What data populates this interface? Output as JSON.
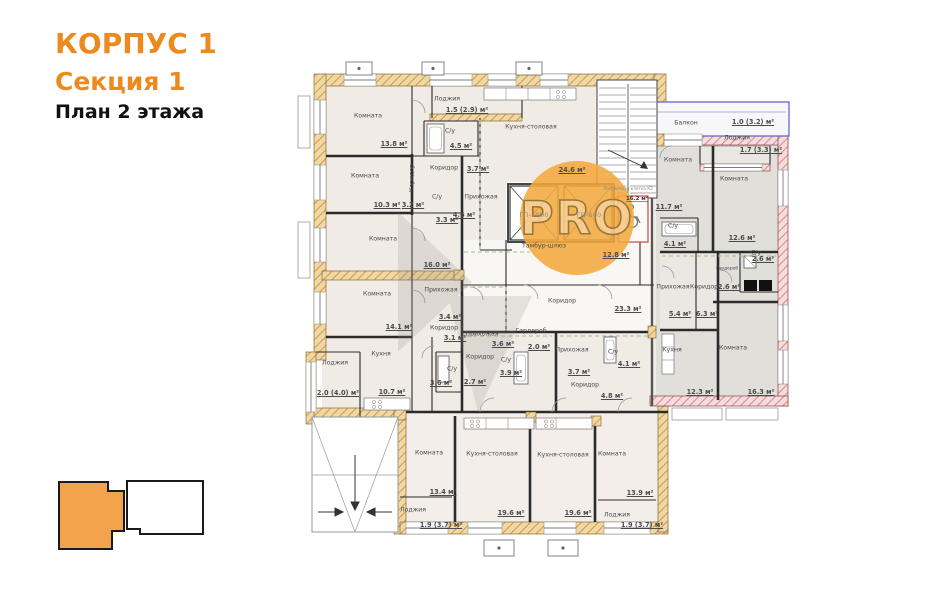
{
  "header": {
    "building": "КОРПУС 1",
    "section": "Секция 1",
    "floor": "План 2 этажа"
  },
  "watermark": {
    "text": "PRO"
  },
  "colors": {
    "accent": "#ec8a1d",
    "exterior_wall_hatch": "#cf9a44",
    "right_section_hatch": "#d08c8c",
    "balcony_outline": "#6868c6",
    "key_section_fill": "#f3a34c",
    "watermark_circle": "#f3a83c"
  },
  "elevators": [
    {
      "label": "ГП-1000"
    },
    {
      "label": "ГП-600"
    }
  ],
  "stairwell": {
    "label": "Лестничная клетка К2",
    "area": "16.2 м²"
  },
  "rooms": [
    {
      "name": "Комната",
      "area": "13.8 м²"
    },
    {
      "name": "Лоджия",
      "area": "1.5 (2.9) м²"
    },
    {
      "name": "С/у",
      "area": "4.5 м²"
    },
    {
      "name": "Кухня-столовая",
      "area": "24.6 м²"
    },
    {
      "name": "Комната",
      "area": "10.3 м²"
    },
    {
      "name": "Коридор",
      "area": "3.2 м²"
    },
    {
      "name": "Коридор",
      "area": "3.7 м²"
    },
    {
      "name": "С/у",
      "area": "3.3 м²"
    },
    {
      "name": "Прихожая",
      "area": "4.6 м²"
    },
    {
      "name": "Комната",
      "area": "16.0 м²"
    },
    {
      "name": "Комната",
      "area": "14.1 м²"
    },
    {
      "name": "Прихожая",
      "area": "3.4 м²"
    },
    {
      "name": "Коридор",
      "area": "3.1 м²"
    },
    {
      "name": "С/у",
      "area": "3.6 м²"
    },
    {
      "name": "",
      "area": "2.7 м²"
    },
    {
      "name": "Кухня",
      "area": "10.7 м²"
    },
    {
      "name": "Лоджия",
      "area": "2.0 (4.0) м²"
    },
    {
      "name": "Тамбур-шлюз",
      "area": "12.8 м²"
    },
    {
      "name": "Коридор",
      "area": "23.3 м²"
    },
    {
      "name": "Прихожая",
      "area": "3.6 м²"
    },
    {
      "name": "Гардероб",
      "area": "2.0 м²"
    },
    {
      "name": "Коридор",
      "area": ""
    },
    {
      "name": "С/у",
      "area": "3.9 м²"
    },
    {
      "name": "Прихожая",
      "area": "3.7 м²"
    },
    {
      "name": "С/у",
      "area": "4.1 м²"
    },
    {
      "name": "Коридор",
      "area": "4.8 м²"
    },
    {
      "name": "Комната",
      "area": "13.4 м²"
    },
    {
      "name": "Лоджия",
      "area": "1.9 (3.7) м²"
    },
    {
      "name": "Кухня-столовая",
      "area": "19.6 м²"
    },
    {
      "name": "Кухня-столовая",
      "area": "19.6 м²"
    },
    {
      "name": "Комната",
      "area": "13.9 м²"
    },
    {
      "name": "Лоджия",
      "area": "1.9 (3.7) м²"
    },
    {
      "name": "Балкон",
      "area": "1.0 (3.2) м²"
    },
    {
      "name": "Лоджия",
      "area": "1.7 (3.3) м²"
    },
    {
      "name": "Комната",
      "area": "11.7 м²"
    },
    {
      "name": "Комната",
      "area": "12.6 м²"
    },
    {
      "name": "С/у",
      "area": "4.1 м²"
    },
    {
      "name": "С/у",
      "area": "2.6 м²"
    },
    {
      "name": "Гардероб",
      "area": "2.6 м²"
    },
    {
      "name": "Прихожая",
      "area": "5.4 м²"
    },
    {
      "name": "Коридор",
      "area": "6.3 м²"
    },
    {
      "name": "Кухня",
      "area": "12.3 м²"
    },
    {
      "name": "Комната",
      "area": "16.3 м²"
    }
  ]
}
